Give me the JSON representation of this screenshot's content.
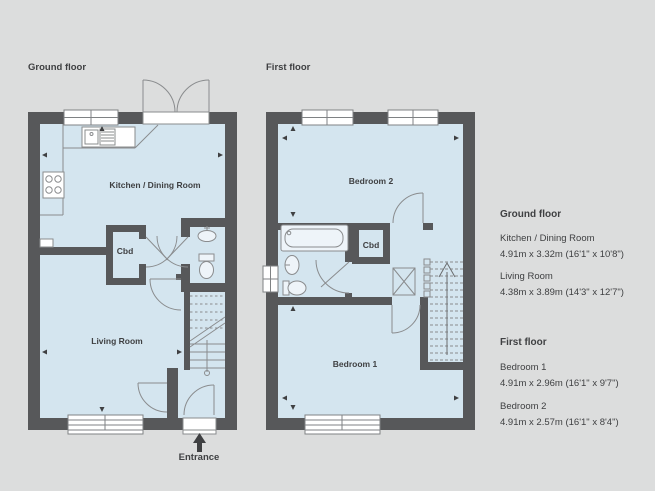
{
  "palette": {
    "background": "#dcdddd",
    "wall": "#57585a",
    "room_fill": "#d4e5ef",
    "fixture_line": "#8a8c8e",
    "text": "#3f4042",
    "window_fill": "#ffffff"
  },
  "plans": {
    "ground": {
      "title": "Ground floor",
      "kitchen_dining": "Kitchen / Dining Room",
      "cupboard": "Cbd",
      "living": "Living Room",
      "entrance": "Entrance"
    },
    "first": {
      "title": "First floor",
      "bedroom2": "Bedroom 2",
      "cupboard": "Cbd",
      "bedroom1": "Bedroom 1"
    }
  },
  "legend": {
    "ground": {
      "heading": "Ground floor",
      "items": [
        {
          "name": "Kitchen / Dining Room",
          "dims": "4.91m x 3.32m (16'1\" x 10'8\")"
        },
        {
          "name": "Living Room",
          "dims": "4.38m x 3.89m (14'3\" x 12'7\")"
        }
      ]
    },
    "first": {
      "heading": "First floor",
      "items": [
        {
          "name": "Bedroom 1",
          "dims": "4.91m x 2.96m (16'1\" x 9'7\")"
        },
        {
          "name": "Bedroom 2",
          "dims": "4.91m x 2.57m  (16'1\" x 8'4\")"
        }
      ]
    }
  }
}
